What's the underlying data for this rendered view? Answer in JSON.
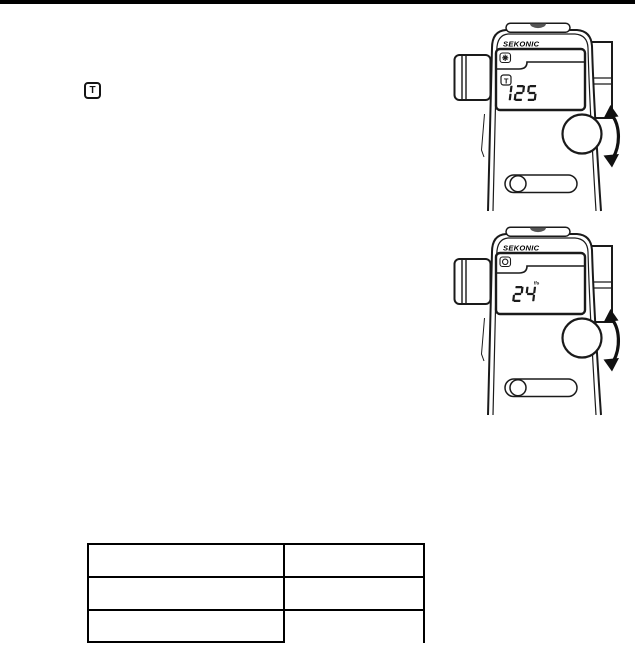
{
  "page": {
    "top_bar_color": "#000000"
  },
  "shutter_priority_icon": {
    "label": "T"
  },
  "devices": [
    {
      "brand": "SEKONIC",
      "mode_icon": "sun-icon",
      "shutter_mode_label": "T",
      "lcd_value": "125",
      "lcd_suffix": ""
    },
    {
      "brand": "SEKONIC",
      "mode_icon": "cine-camera-icon",
      "lcd_value": "24",
      "lcd_suffix": "f/s"
    }
  ],
  "table": {
    "rows": [
      [
        "",
        ""
      ],
      [
        "",
        ""
      ],
      [
        "",
        ""
      ]
    ]
  }
}
